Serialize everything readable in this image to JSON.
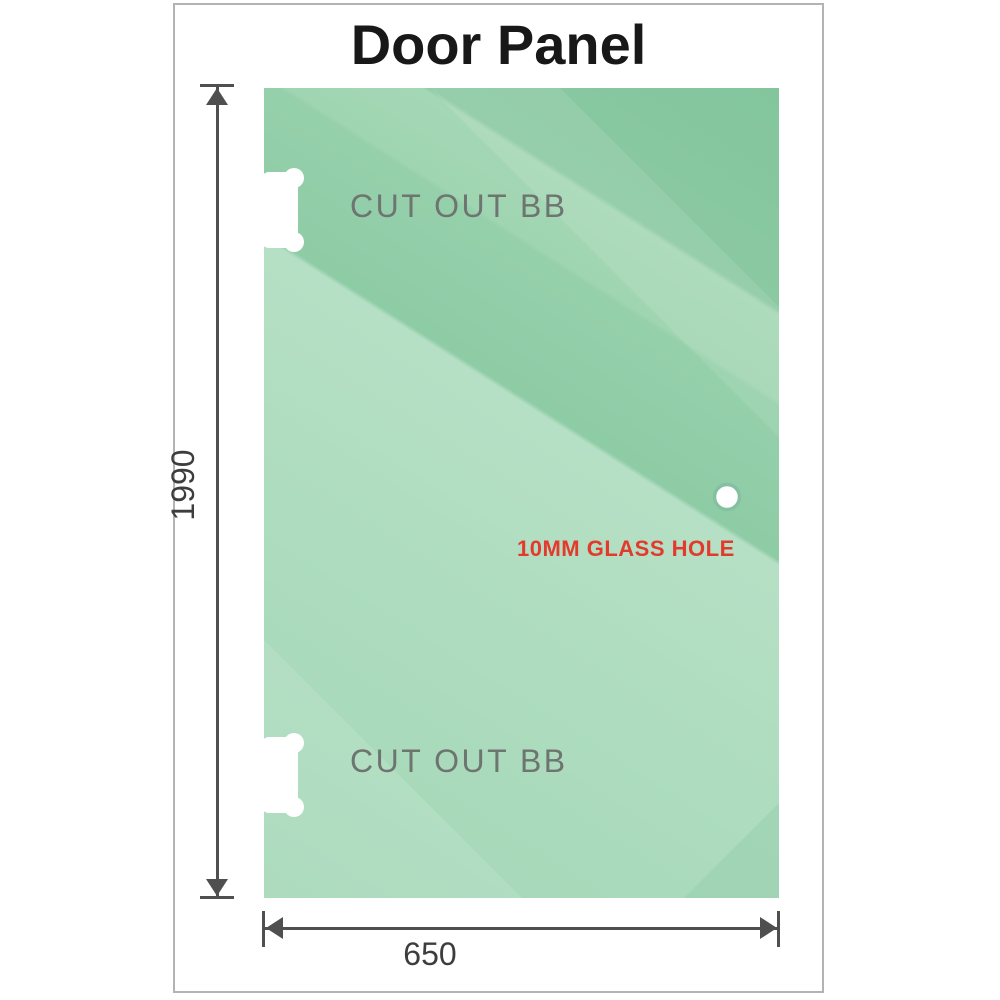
{
  "title": "Door Panel",
  "diagram": {
    "dimensions": {
      "height": "1990",
      "width": "650"
    },
    "cutouts": {
      "top": {
        "label": "CUT OUT BB"
      },
      "bottom": {
        "label": "CUT OUT BB"
      }
    },
    "hole": {
      "label": "10MM GLASS HOLE"
    },
    "colors": {
      "glass_base": "#9fd5b4",
      "glass_light": "#b4dfc3",
      "glass_dark": "#86c79f",
      "dimension_line": "#4f4f4f",
      "dimension_text": "#3d3d3d",
      "cutout_label": "#6e7470",
      "hole_label": "#e23b2e",
      "frame_border": "#b3b3b3"
    }
  }
}
